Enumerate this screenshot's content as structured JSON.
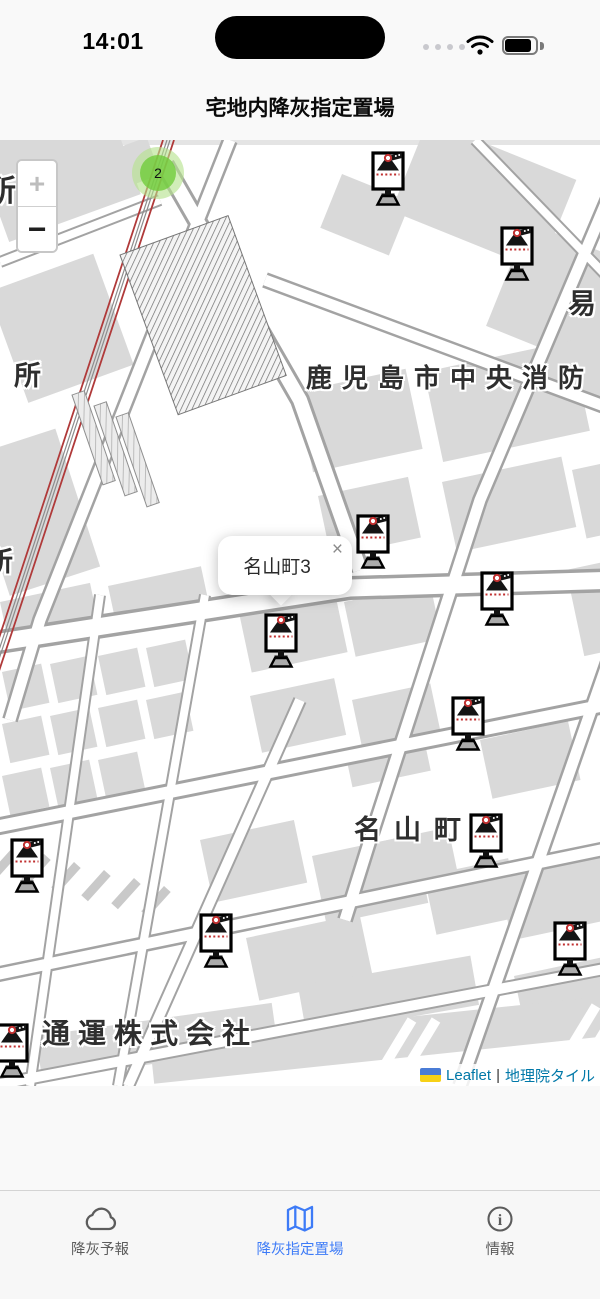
{
  "status_bar": {
    "time": "14:01"
  },
  "header": {
    "title": "宅地内降灰指定置場"
  },
  "map": {
    "zoom_in_label": "+",
    "zoom_out_label": "−",
    "cluster": {
      "count": "2"
    },
    "popup": {
      "text": "名山町3",
      "close_label": "×"
    },
    "labels": [
      {
        "text": "所",
        "x": -14,
        "y": 26,
        "size": 30,
        "ls": 0
      },
      {
        "text": "所",
        "x": 14,
        "y": 214,
        "size": 27,
        "ls": 0
      },
      {
        "text": "鹿児島市中央消防",
        "x": 306,
        "y": 218,
        "size": 26,
        "ls": 10
      },
      {
        "text": "易",
        "x": 568,
        "y": 142,
        "size": 28,
        "ls": 0
      },
      {
        "text": "所",
        "x": -14,
        "y": 400,
        "size": 27,
        "ls": 0
      },
      {
        "text": "名山町",
        "x": 354,
        "y": 668,
        "size": 27,
        "ls": 13
      },
      {
        "text": "通運株式会社",
        "x": 42,
        "y": 872,
        "size": 28,
        "ls": 8
      }
    ],
    "markers": [
      {
        "x": 370,
        "y": 10
      },
      {
        "x": 499,
        "y": 85
      },
      {
        "x": 355,
        "y": 373
      },
      {
        "x": 479,
        "y": 430
      },
      {
        "x": 263,
        "y": 472
      },
      {
        "x": 450,
        "y": 555
      },
      {
        "x": 468,
        "y": 672
      },
      {
        "x": 9,
        "y": 697
      },
      {
        "x": 198,
        "y": 772
      },
      {
        "x": 552,
        "y": 780
      },
      {
        "x": -6,
        "y": 882
      }
    ],
    "attribution": {
      "leaflet": "Leaflet",
      "separator": "|",
      "tiles": "地理院タイル"
    }
  },
  "tab_bar": {
    "active_color": "#3D7BF7",
    "tabs": [
      {
        "label": "降灰予報",
        "icon": "cloud-icon",
        "active": false
      },
      {
        "label": "降灰指定置場",
        "icon": "map-icon",
        "active": true
      },
      {
        "label": "情報",
        "icon": "info-icon",
        "active": false
      }
    ]
  }
}
